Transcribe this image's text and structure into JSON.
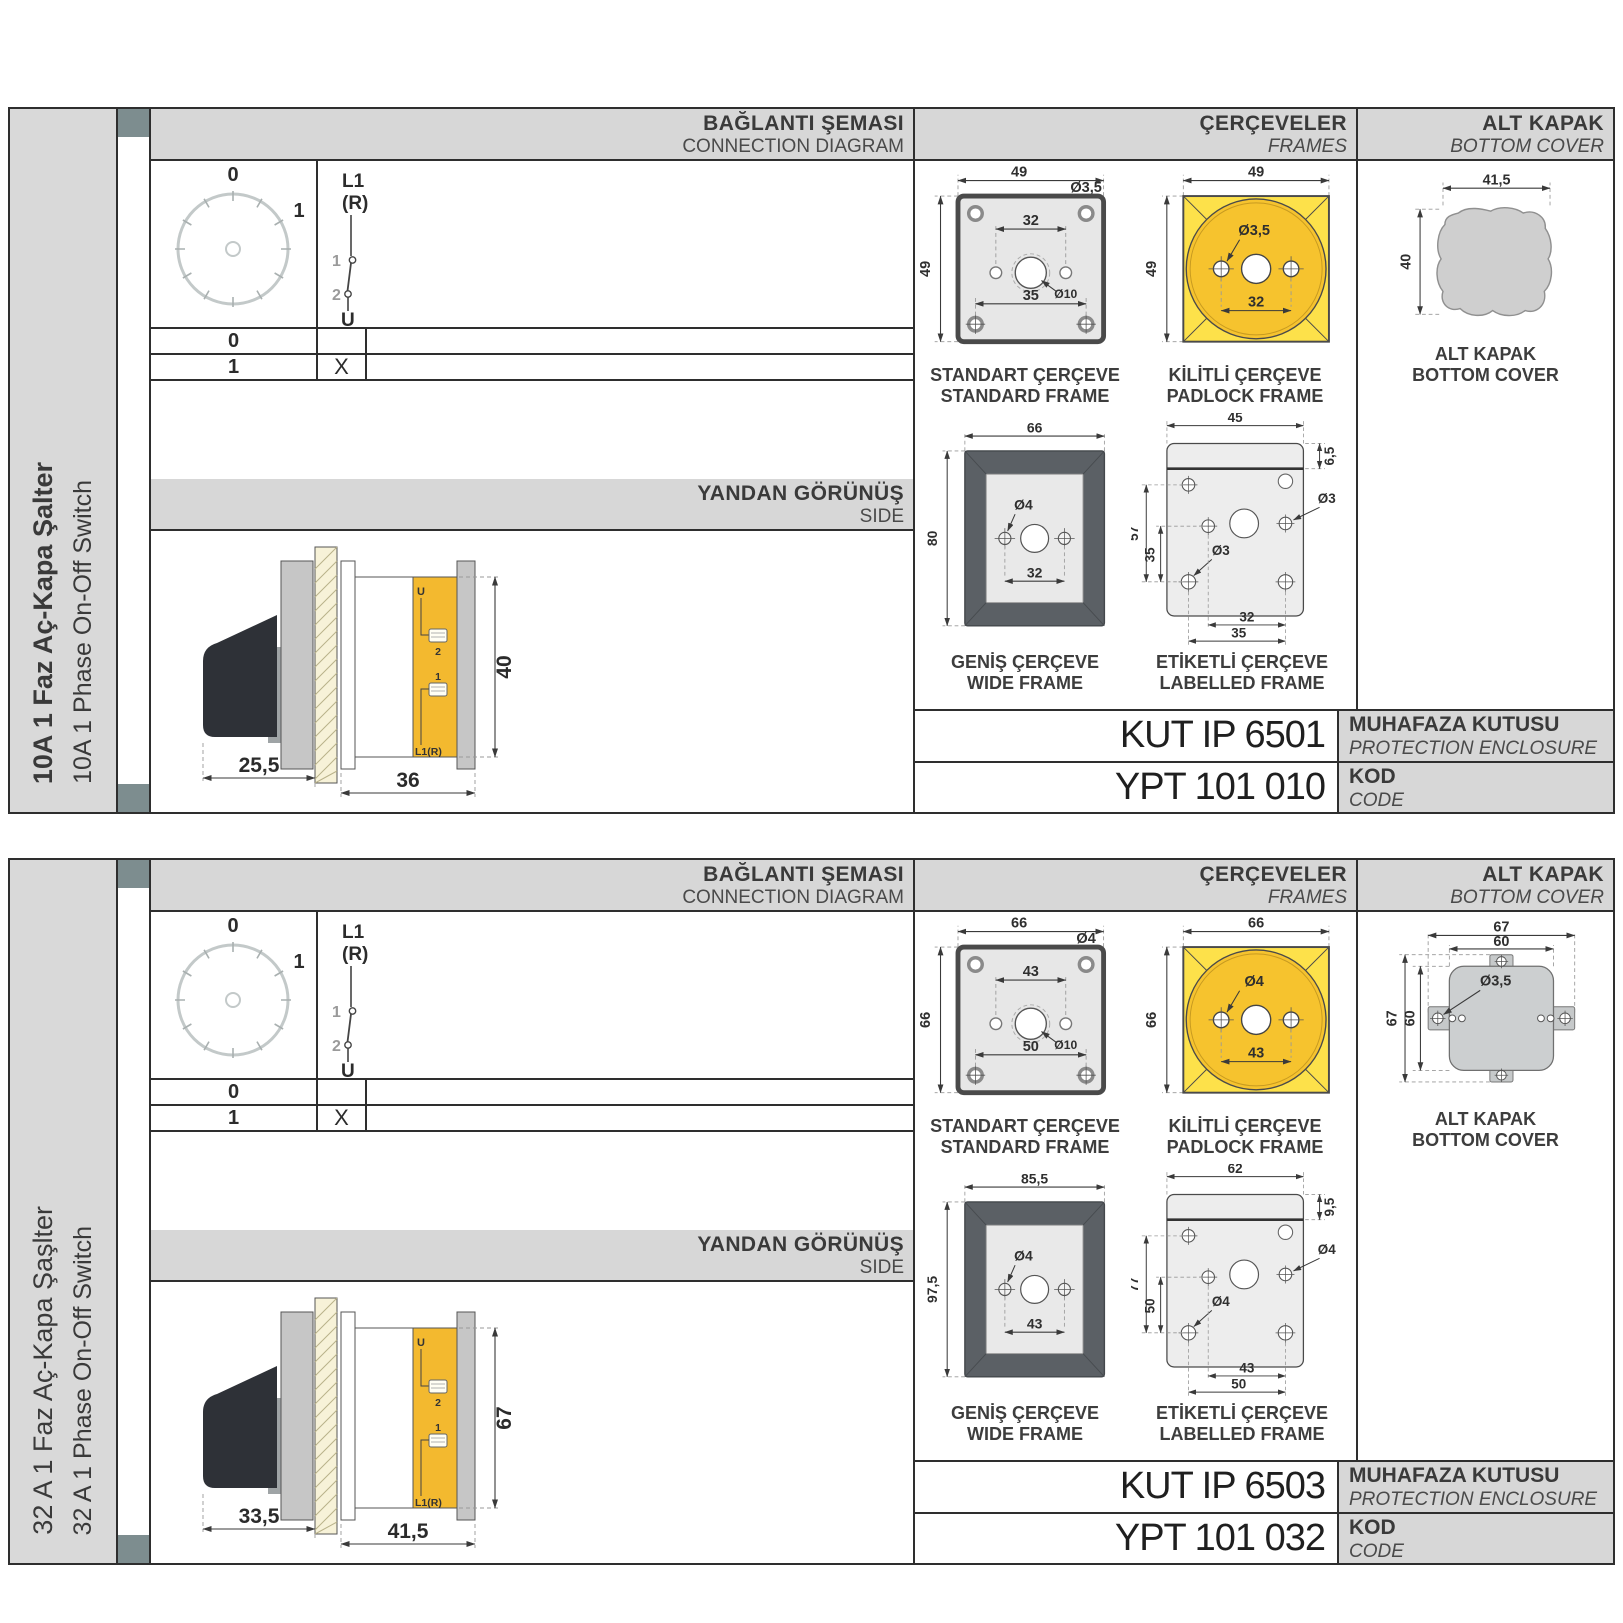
{
  "colors": {
    "frame_square_yellow": "#fde14a",
    "frame_circle_gold": "#f6c32e",
    "side_body_yellow": "#f3b92f",
    "band_grey": "#d7d7d7",
    "tab_grey": "#7d8d8f",
    "handle_black": "#2e3137",
    "cover_grey": "#cfcfcf"
  },
  "sections": [
    {
      "sidebar": {
        "tr": "10A 1 Faz Aç-Kapa Şalter",
        "en": "10A 1 Phase On-Off Switch"
      },
      "connection": {
        "tr": "BAĞLANTI ŞEMASI",
        "en": "CONNECTION DIAGRAM",
        "p0": "0",
        "p1": "1",
        "l1": "L1",
        "r": "(R)",
        "c1": "1",
        "c2": "2",
        "u": "U",
        "row0": {
          "pos": "0",
          "mark": ""
        },
        "row1": {
          "pos": "1",
          "mark": "X"
        }
      },
      "sideview": {
        "tr": "YANDAN GÖRÜNÜŞ",
        "en": "SIDE",
        "u": "U",
        "t2": "2",
        "t1": "1",
        "l1r": "L1(R)",
        "d1": "25,5",
        "d2": "36",
        "d3": "40"
      },
      "frames": {
        "tr": "ÇERÇEVELER",
        "en": "FRAMES",
        "standard": {
          "tr": "STANDART ÇERÇEVE",
          "en": "STANDARD FRAME",
          "w": "49",
          "h": "49",
          "mid": "32",
          "bot": "35",
          "hole": "Ø3,5",
          "center": "Ø10"
        },
        "padlock": {
          "tr": "KİLİTLİ ÇERÇEVE",
          "en": "PADLOCK FRAME",
          "w": "49",
          "h": "49",
          "mid": "32",
          "hole": "Ø3,5"
        },
        "wide": {
          "tr": "GENİŞ ÇERÇEVE",
          "en": "WIDE FRAME",
          "w": "66",
          "h": "80",
          "mid": "32",
          "hole": "Ø4"
        },
        "labelled": {
          "tr": "ETİKETLİ ÇERÇEVE",
          "en": "LABELLED FRAME",
          "w": "45",
          "strip": "6,5",
          "h": "57",
          "h2": "35",
          "hole": "Ø3",
          "hole2": "Ø3",
          "bot1": "32",
          "bot2": "35"
        }
      },
      "cover": {
        "tr": "ALT KAPAK",
        "en": "BOTTOM COVER",
        "cap_tr": "ALT KAPAK",
        "cap_en": "BOTTOM COVER",
        "w": "41,5",
        "h": "40"
      },
      "codes": {
        "enclosure": "KUT IP 6501",
        "enc_tr": "MUHAFAZA KUTUSU",
        "enc_en": "PROTECTION ENCLOSURE",
        "code": "YPT 101 010",
        "kod_tr": "KOD",
        "kod_en": "CODE"
      }
    },
    {
      "sidebar": {
        "tr": "32 A 1 Faz Aç-Kapa Şaşlter",
        "en": "32 A 1 Phase On-Off Switch"
      },
      "connection": {
        "tr": "BAĞLANTI ŞEMASI",
        "en": "CONNECTION DIAGRAM",
        "p0": "0",
        "p1": "1",
        "l1": "L1",
        "r": "(R)",
        "c1": "1",
        "c2": "2",
        "u": "U",
        "row0": {
          "pos": "0",
          "mark": ""
        },
        "row1": {
          "pos": "1",
          "mark": "X"
        }
      },
      "sideview": {
        "tr": "YANDAN GÖRÜNÜŞ",
        "en": "SIDE",
        "u": "U",
        "t2": "2",
        "t1": "1",
        "l1r": "L1(R)",
        "d1": "33,5",
        "d2": "41,5",
        "d3": "67"
      },
      "frames": {
        "tr": "ÇERÇEVELER",
        "en": "FRAMES",
        "standard": {
          "tr": "STANDART ÇERÇEVE",
          "en": "STANDARD FRAME",
          "w": "66",
          "h": "66",
          "mid": "43",
          "bot": "50",
          "hole": "Ø4",
          "center": "Ø10"
        },
        "padlock": {
          "tr": "KİLİTLİ ÇERÇEVE",
          "en": "PADLOCK FRAME",
          "w": "66",
          "h": "66",
          "mid": "43",
          "hole": "Ø4"
        },
        "wide": {
          "tr": "GENİŞ ÇERÇEVE",
          "en": "WIDE FRAME",
          "w": "85,5",
          "h": "97,5",
          "mid": "43",
          "hole": "Ø4"
        },
        "labelled": {
          "tr": "ETİKETLİ ÇERÇEVE",
          "en": "LABELLED FRAME",
          "w": "62",
          "strip": "9,5",
          "h": "77",
          "h2": "50",
          "hole": "Ø4",
          "hole2": "Ø4",
          "bot1": "43",
          "bot2": "50"
        }
      },
      "cover": {
        "tr": "ALT KAPAK",
        "en": "BOTTOM COVER",
        "cap_tr": "ALT KAPAK",
        "cap_en": "BOTTOM COVER",
        "w_out": "67",
        "w_in": "60",
        "h_out": "67",
        "h_in": "60",
        "hole": "Ø3,5"
      },
      "codes": {
        "enclosure": "KUT IP 6503",
        "enc_tr": "MUHAFAZA KUTUSU",
        "enc_en": "PROTECTION ENCLOSURE",
        "code": "YPT 101 032",
        "kod_tr": "KOD",
        "kod_en": "CODE"
      }
    }
  ]
}
